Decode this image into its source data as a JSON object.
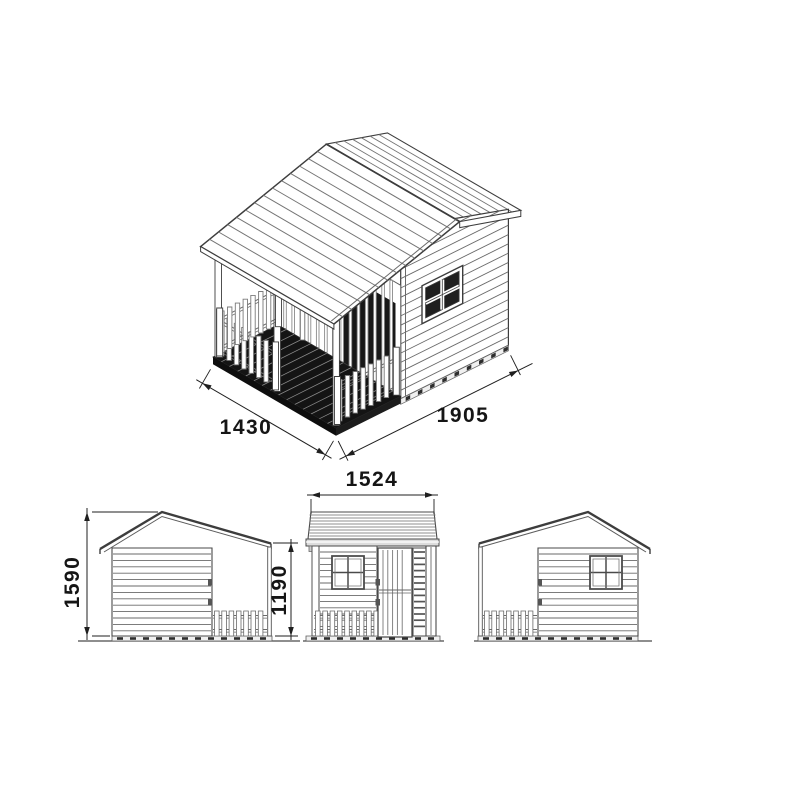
{
  "drawing": {
    "title": "playhouse-technical-drawing",
    "dimensions": {
      "iso_width_mm": "1430",
      "iso_depth_mm": "1905",
      "front_width_mm": "1524",
      "ridge_height_mm": "1590",
      "eave_height_mm": "1190"
    },
    "colors": {
      "line": "#6a6a6a",
      "plank": "#747474",
      "outline": "#3d3d3d",
      "wallfill": "#ffffff",
      "deck_top": "#141414",
      "deck_front": "#0e0e0e",
      "deck_side": "#1c1c1c",
      "pane": "#202020",
      "door_opening": "#181818",
      "base_band": "#f0f0f0",
      "base_dash": "#2d2d2d",
      "fascia": "#dcdcdc",
      "dim": "#1f1f1f",
      "text": "#151515"
    }
  }
}
